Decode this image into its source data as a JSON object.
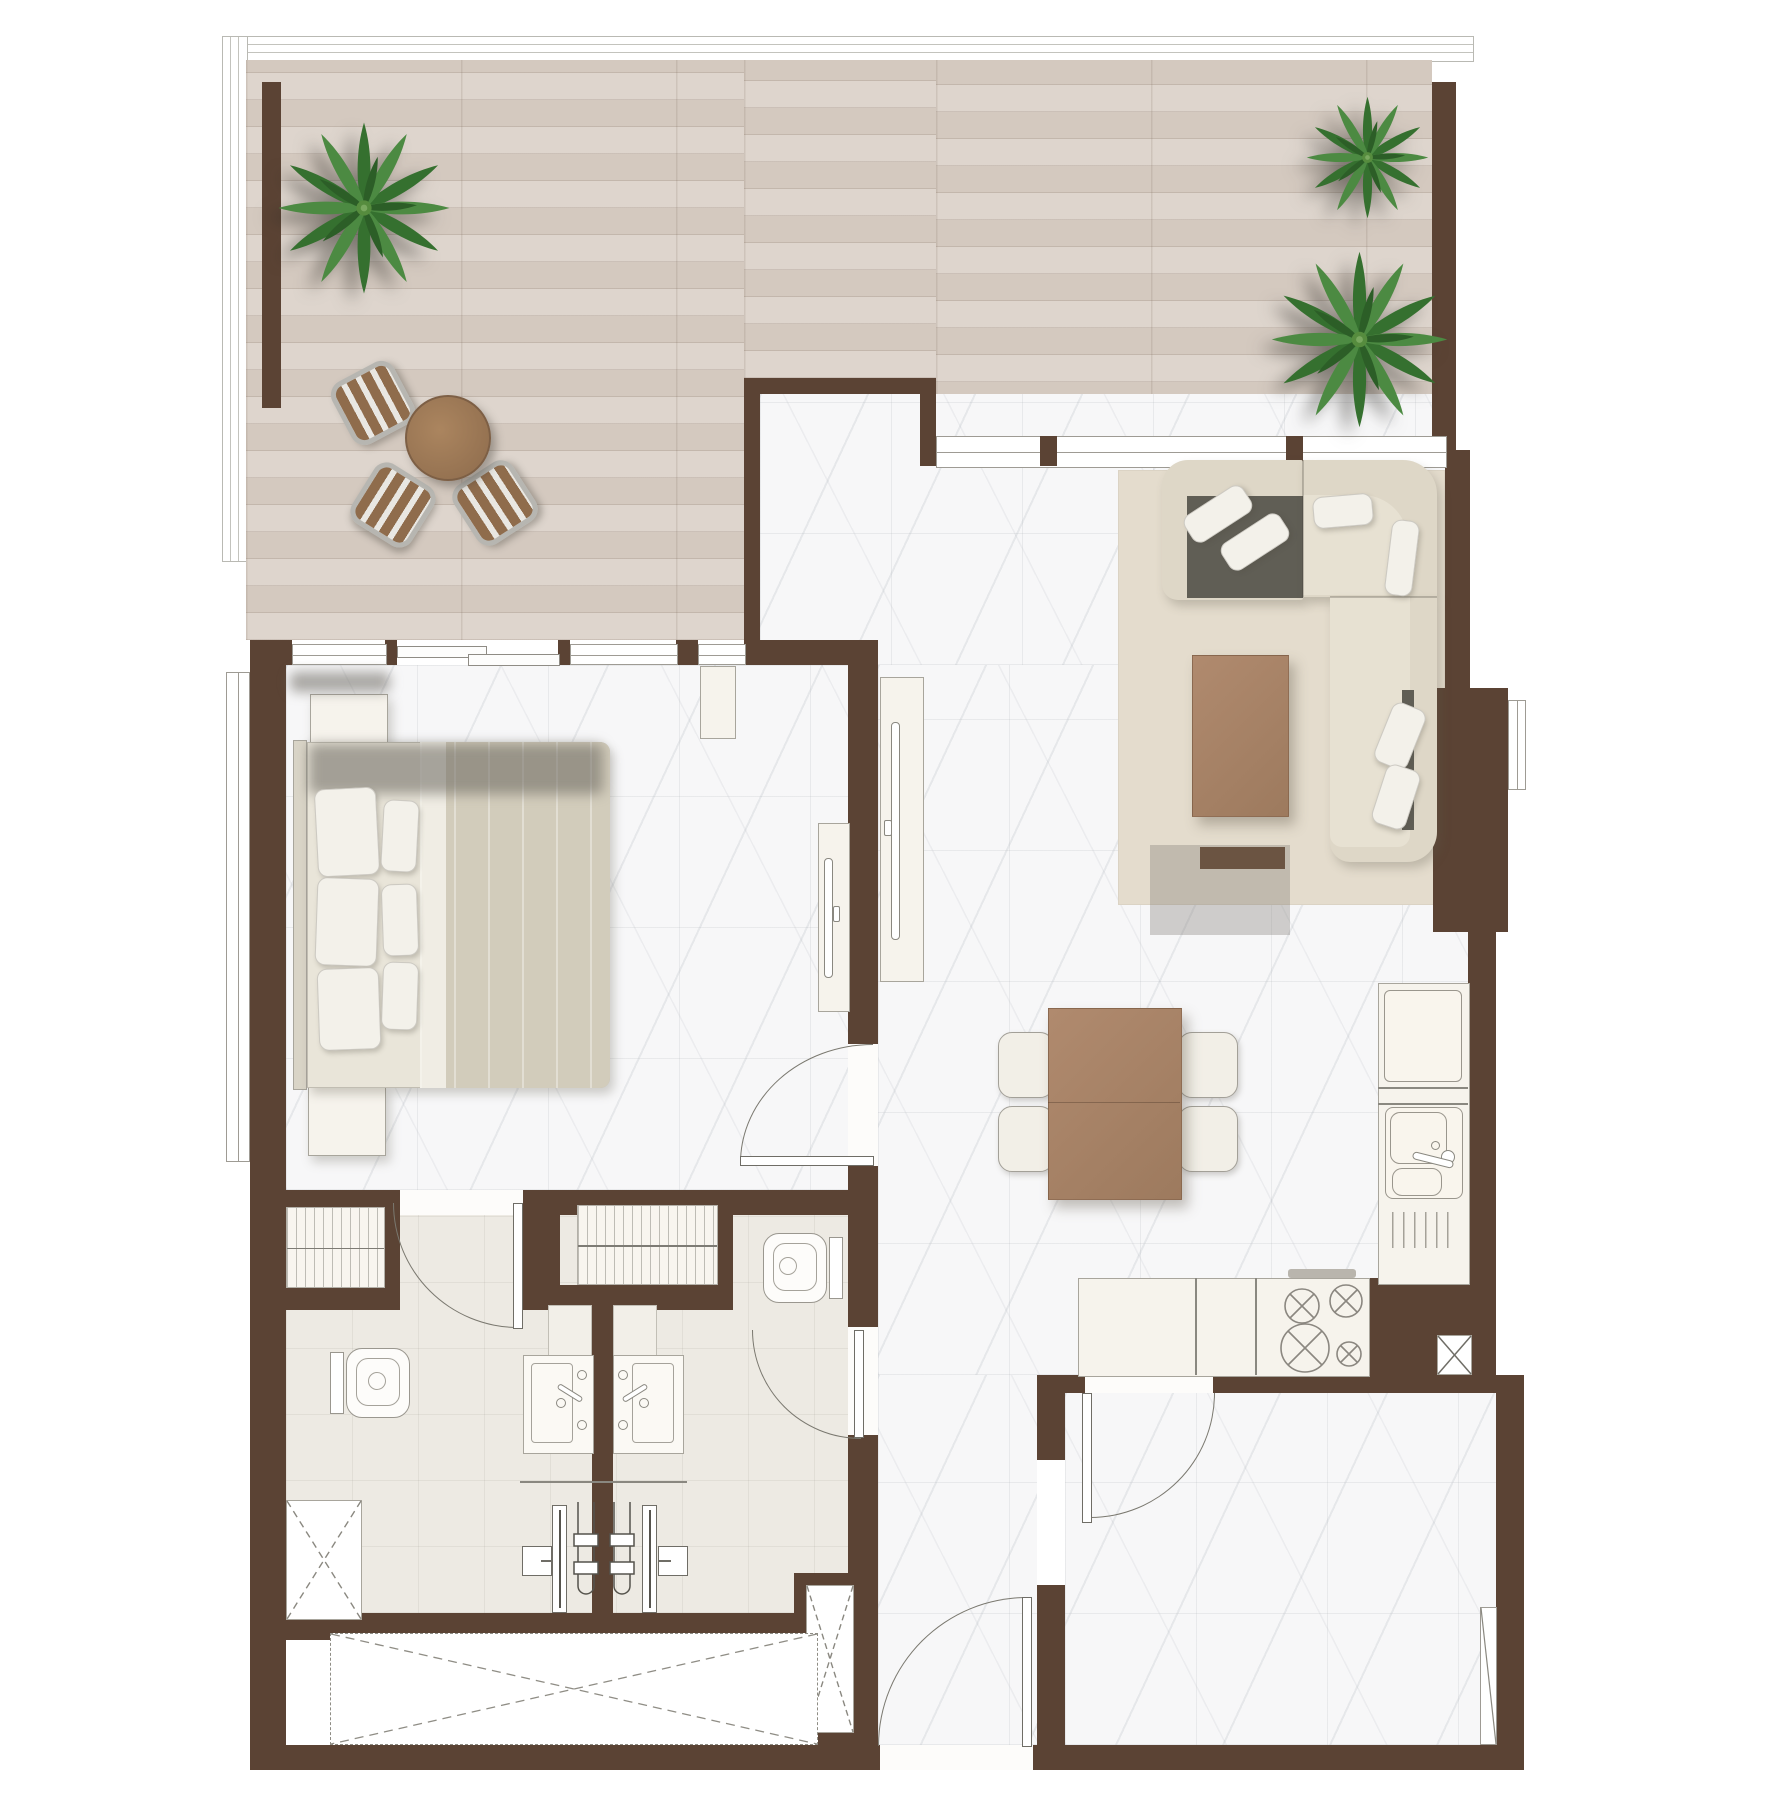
{
  "meta": {
    "type": "apartment-floor-plan",
    "view": "top-down architectural render",
    "visible_text": "none"
  },
  "palette": {
    "wall": "#5b4334",
    "terrace_wood_floor": "#d9cfc6",
    "marble_floor": "#f7f7f8",
    "bathroom_floor": "#edeae3",
    "rug": "#e4dccd",
    "sofa_fabric": "#ded7c7",
    "sofa_seat_dark": "#605e55",
    "cushion_white": "#f3f1ea",
    "bed_blanket": "#d2ccbb",
    "wood_furniture": "#a8836a",
    "kitchen_counter": "#f6f3ec",
    "palm_green": "#3f7d3c",
    "fixture_outline": "#85837b",
    "glass_line": "#b9b9b3"
  },
  "terrace": {
    "palm_trees": 3,
    "bistro_table": 1,
    "bistro_chairs": 3,
    "glass_balustrade": true,
    "floor": "wood planks"
  },
  "bedroom": {
    "double_bed": 1,
    "bed_pillows": 6,
    "nightstands": 2,
    "dresser": 1,
    "tv_console": 1,
    "window_wall": true,
    "sliding_terrace_door": true,
    "floor": "marble tile"
  },
  "living_dining": {
    "sectional_sofa": 1,
    "sofa_cushions": 6,
    "coffee_table": 1,
    "area_rug": 1,
    "tv_console": 1,
    "dining_table": 1,
    "dining_chairs": 4,
    "terrace_window_band": true,
    "floor": "marble tile"
  },
  "kitchen": {
    "fridge": 1,
    "double_sink": 1,
    "faucet": 1,
    "hob_burners": 4,
    "counters": 2,
    "range_hood": 1
  },
  "bathrooms": {
    "count": 2,
    "toilets": 2,
    "vanity_sinks": 2,
    "showers": 2,
    "wardrobe_closets": 2
  },
  "circulation": {
    "swing_doors": 5,
    "entry_door_location": "bottom center",
    "service_shafts": 3,
    "void_panel_dashed": 1,
    "right_wall_column": 1
  }
}
